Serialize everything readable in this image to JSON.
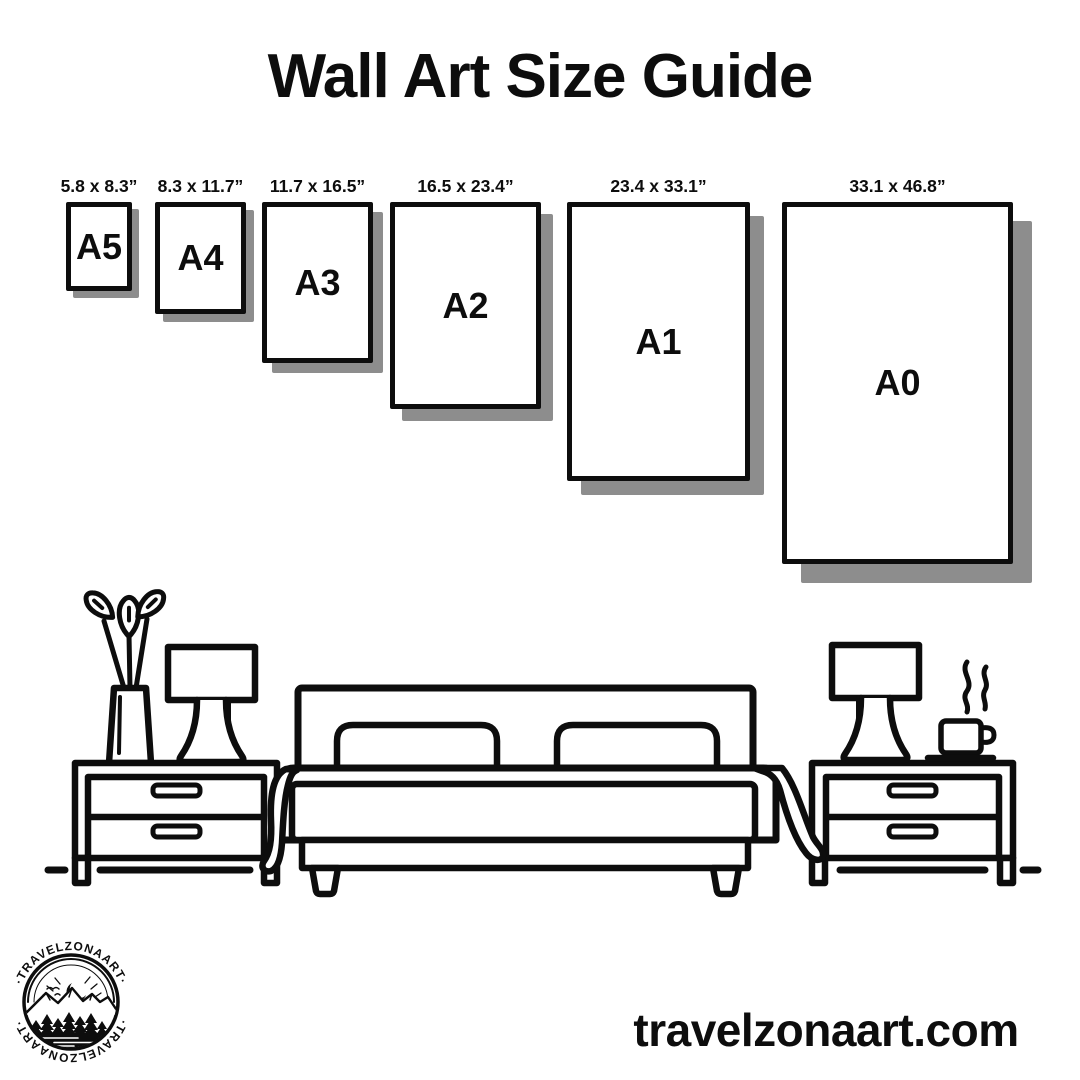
{
  "title": "Wall Art Size Guide",
  "frames": [
    {
      "code": "A5",
      "size": "5.8 x 8.3”"
    },
    {
      "code": "A4",
      "size": "8.3 x 11.7”"
    },
    {
      "code": "A3",
      "size": "11.7 x 16.5”"
    },
    {
      "code": "A2",
      "size": "16.5 x 23.4”"
    },
    {
      "code": "A1",
      "size": "23.4 x 33.1”"
    },
    {
      "code": "A0",
      "size": "33.1 x 46.8”"
    }
  ],
  "scene": {
    "items": [
      "vase-plant",
      "table-lamp-left",
      "nightstand-left",
      "bed",
      "pillows",
      "blanket",
      "nightstand-right",
      "table-lamp-right",
      "coffee-cup",
      "floor-line"
    ]
  },
  "badge": {
    "brand": "TRAVELZONAART",
    "arc_text": "·TRAVELZONAART·"
  },
  "website": "travelzonaart.com",
  "colors": {
    "ink": "#0d0d0d",
    "shadow": "#8d8d8d",
    "bg": "#ffffff"
  }
}
